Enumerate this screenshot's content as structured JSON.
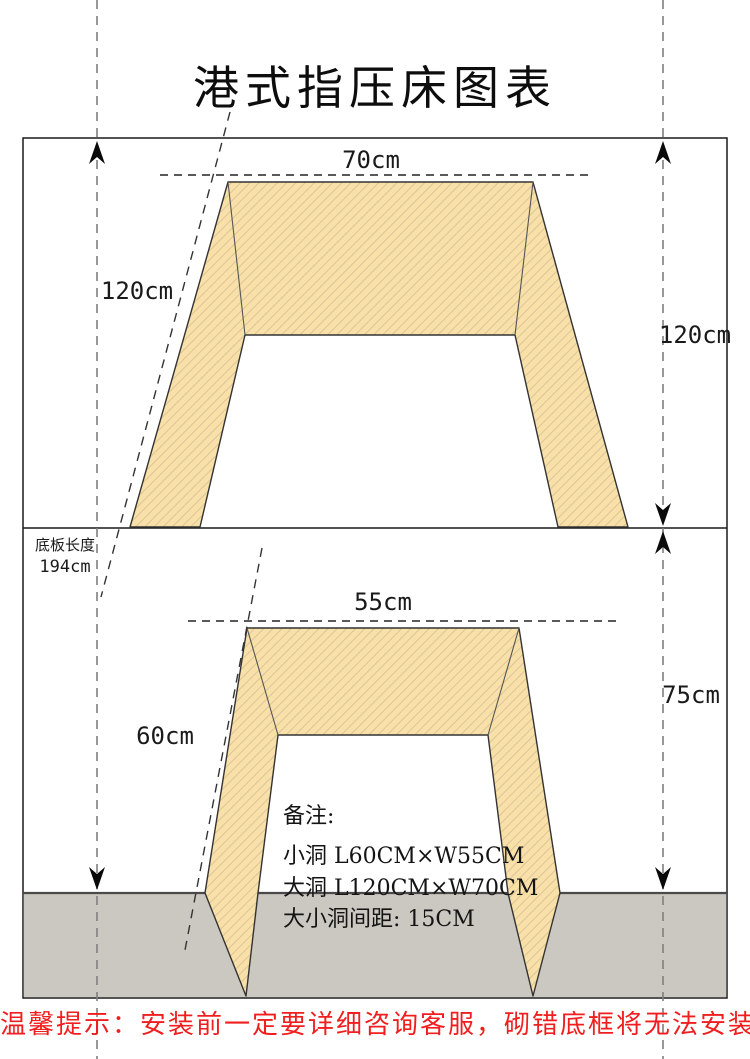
{
  "title": "港式指压床图表",
  "top_view": {
    "width_label": "70cm",
    "height_label_left": "120cm",
    "height_label_right": "120cm"
  },
  "base_board": {
    "name_label": "底板长度",
    "length_label": "194cm"
  },
  "bottom_view": {
    "width_label": "55cm",
    "height_label_left": "60cm",
    "height_label_right": "75cm"
  },
  "notes": {
    "heading": "备注:",
    "lines": [
      "小洞 L60CM×W55CM",
      "大洞 L120CM×W70CM",
      "大小洞间距: 15CM"
    ]
  },
  "footer": {
    "warning": "温馨提示：安装前一定要详细咨询客服，砌错底框将无法安装"
  },
  "colors": {
    "panel_fill": "#F8E0A8",
    "panel_hatch": "#D4BF94",
    "base_gray": "#CBC7C1",
    "outline": "#1A1A1A",
    "dashed_gray": "#7F7F7F",
    "warning_red": "#F01E1E"
  }
}
